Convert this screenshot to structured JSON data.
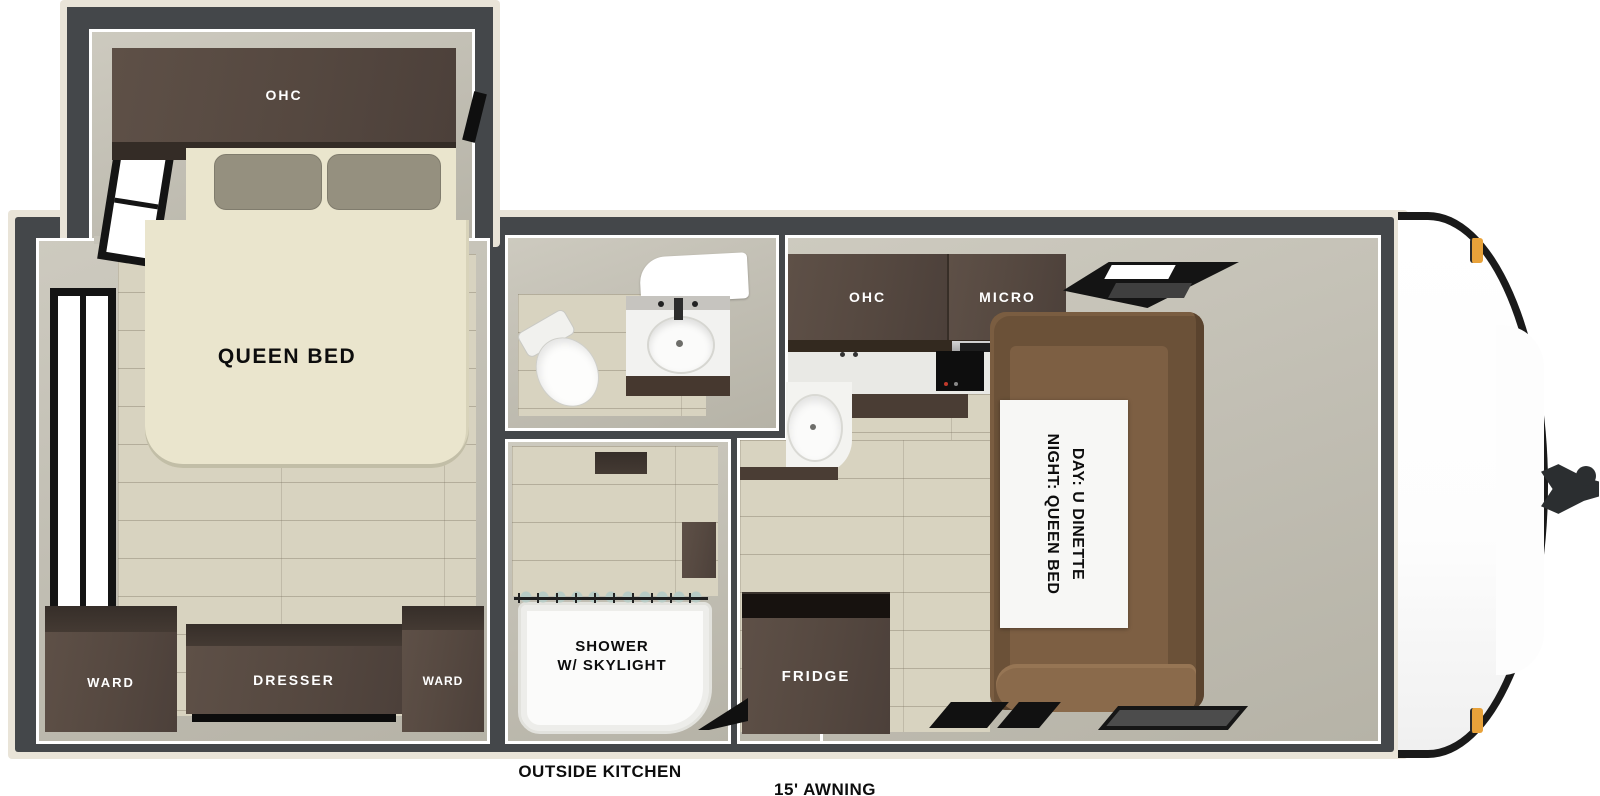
{
  "plan": {
    "bedroom": {
      "ohc": "OHC",
      "queen_bed": "QUEEN BED",
      "ward_left": "WARD",
      "dresser": "DRESSER",
      "ward_right": "WARD"
    },
    "shower": {
      "line1": "SHOWER",
      "line2": "W/ SKYLIGHT"
    },
    "kitchen": {
      "ohc": "OHC",
      "micro": "MICRO",
      "fridge": "FRIDGE"
    },
    "dinette": {
      "line1": "DAY: U DINETTE",
      "line2": "NIGHT: QUEEN BED"
    },
    "exterior": {
      "outside_kitchen": "OUTSIDE KITCHEN",
      "awning": "15' AWNING"
    },
    "colors": {
      "wall_dark": "#44474a",
      "trim_cream": "#e9e4d8",
      "interior_gray": "#c2bfb4",
      "floor_wood": "#d8d3c0",
      "cabinet_brown": "#574a41",
      "dinette_brown": "#6b5138",
      "bed_cream": "#eae5cd",
      "marker_amber": "#e8a23a"
    }
  }
}
